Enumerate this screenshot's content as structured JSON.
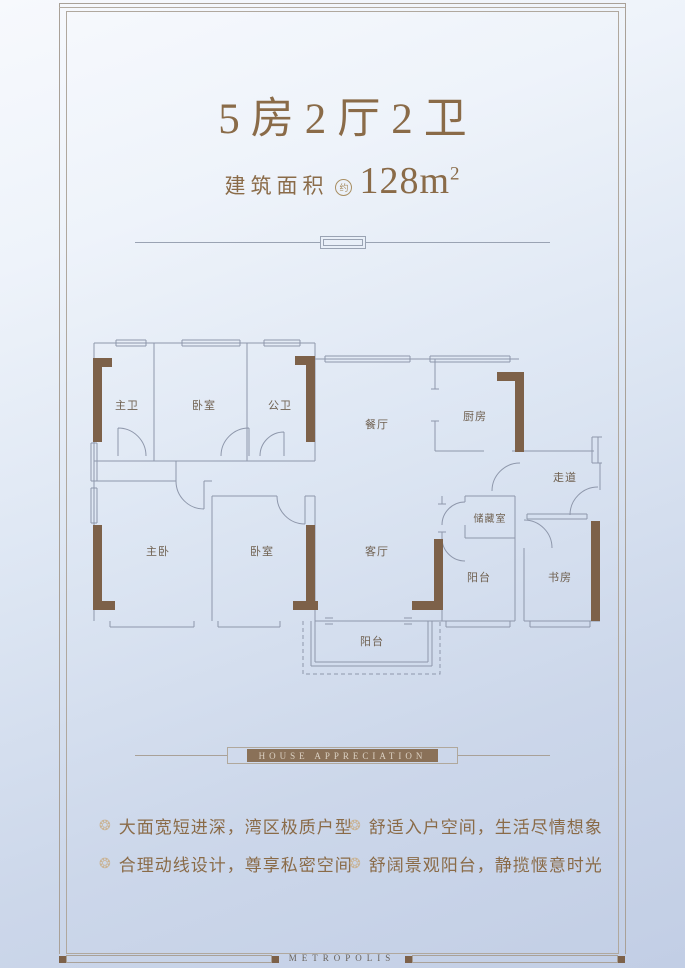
{
  "header": {
    "title": "5房2厅2卫",
    "area_label": "建筑面积",
    "area_note": "约",
    "area_value": "128m",
    "area_sup": "2"
  },
  "banner": {
    "label": "HOUSE APPRECIATION"
  },
  "features": {
    "bullet_icon": "❂",
    "left": [
      "大面宽短进深，湾区极质户型",
      "合理动线设计，尊享私密空间"
    ],
    "right": [
      "舒适入户空间，生活尽情想象",
      "舒阔景观阳台，静揽惬意时光"
    ]
  },
  "floorplan": {
    "rooms": [
      {
        "label": "主卫"
      },
      {
        "label": "卧室"
      },
      {
        "label": "公卫"
      },
      {
        "label": "餐厅"
      },
      {
        "label": "厨房"
      },
      {
        "label": "走道"
      },
      {
        "label": "主卧"
      },
      {
        "label": "卧室"
      },
      {
        "label": "客厅"
      },
      {
        "label": "储藏室"
      },
      {
        "label": "阳台"
      },
      {
        "label": "书房"
      },
      {
        "label": "阳台"
      }
    ]
  },
  "footer": {
    "brand": "METROPOLIS"
  },
  "colors": {
    "accent_brown": "#8a6b48",
    "wall_brown": "#7d6149",
    "plan_line": "#8e97ab",
    "frame_line": "#a9a198",
    "banner_bg": "#8a7158",
    "banner_text": "#dcd2c4"
  }
}
